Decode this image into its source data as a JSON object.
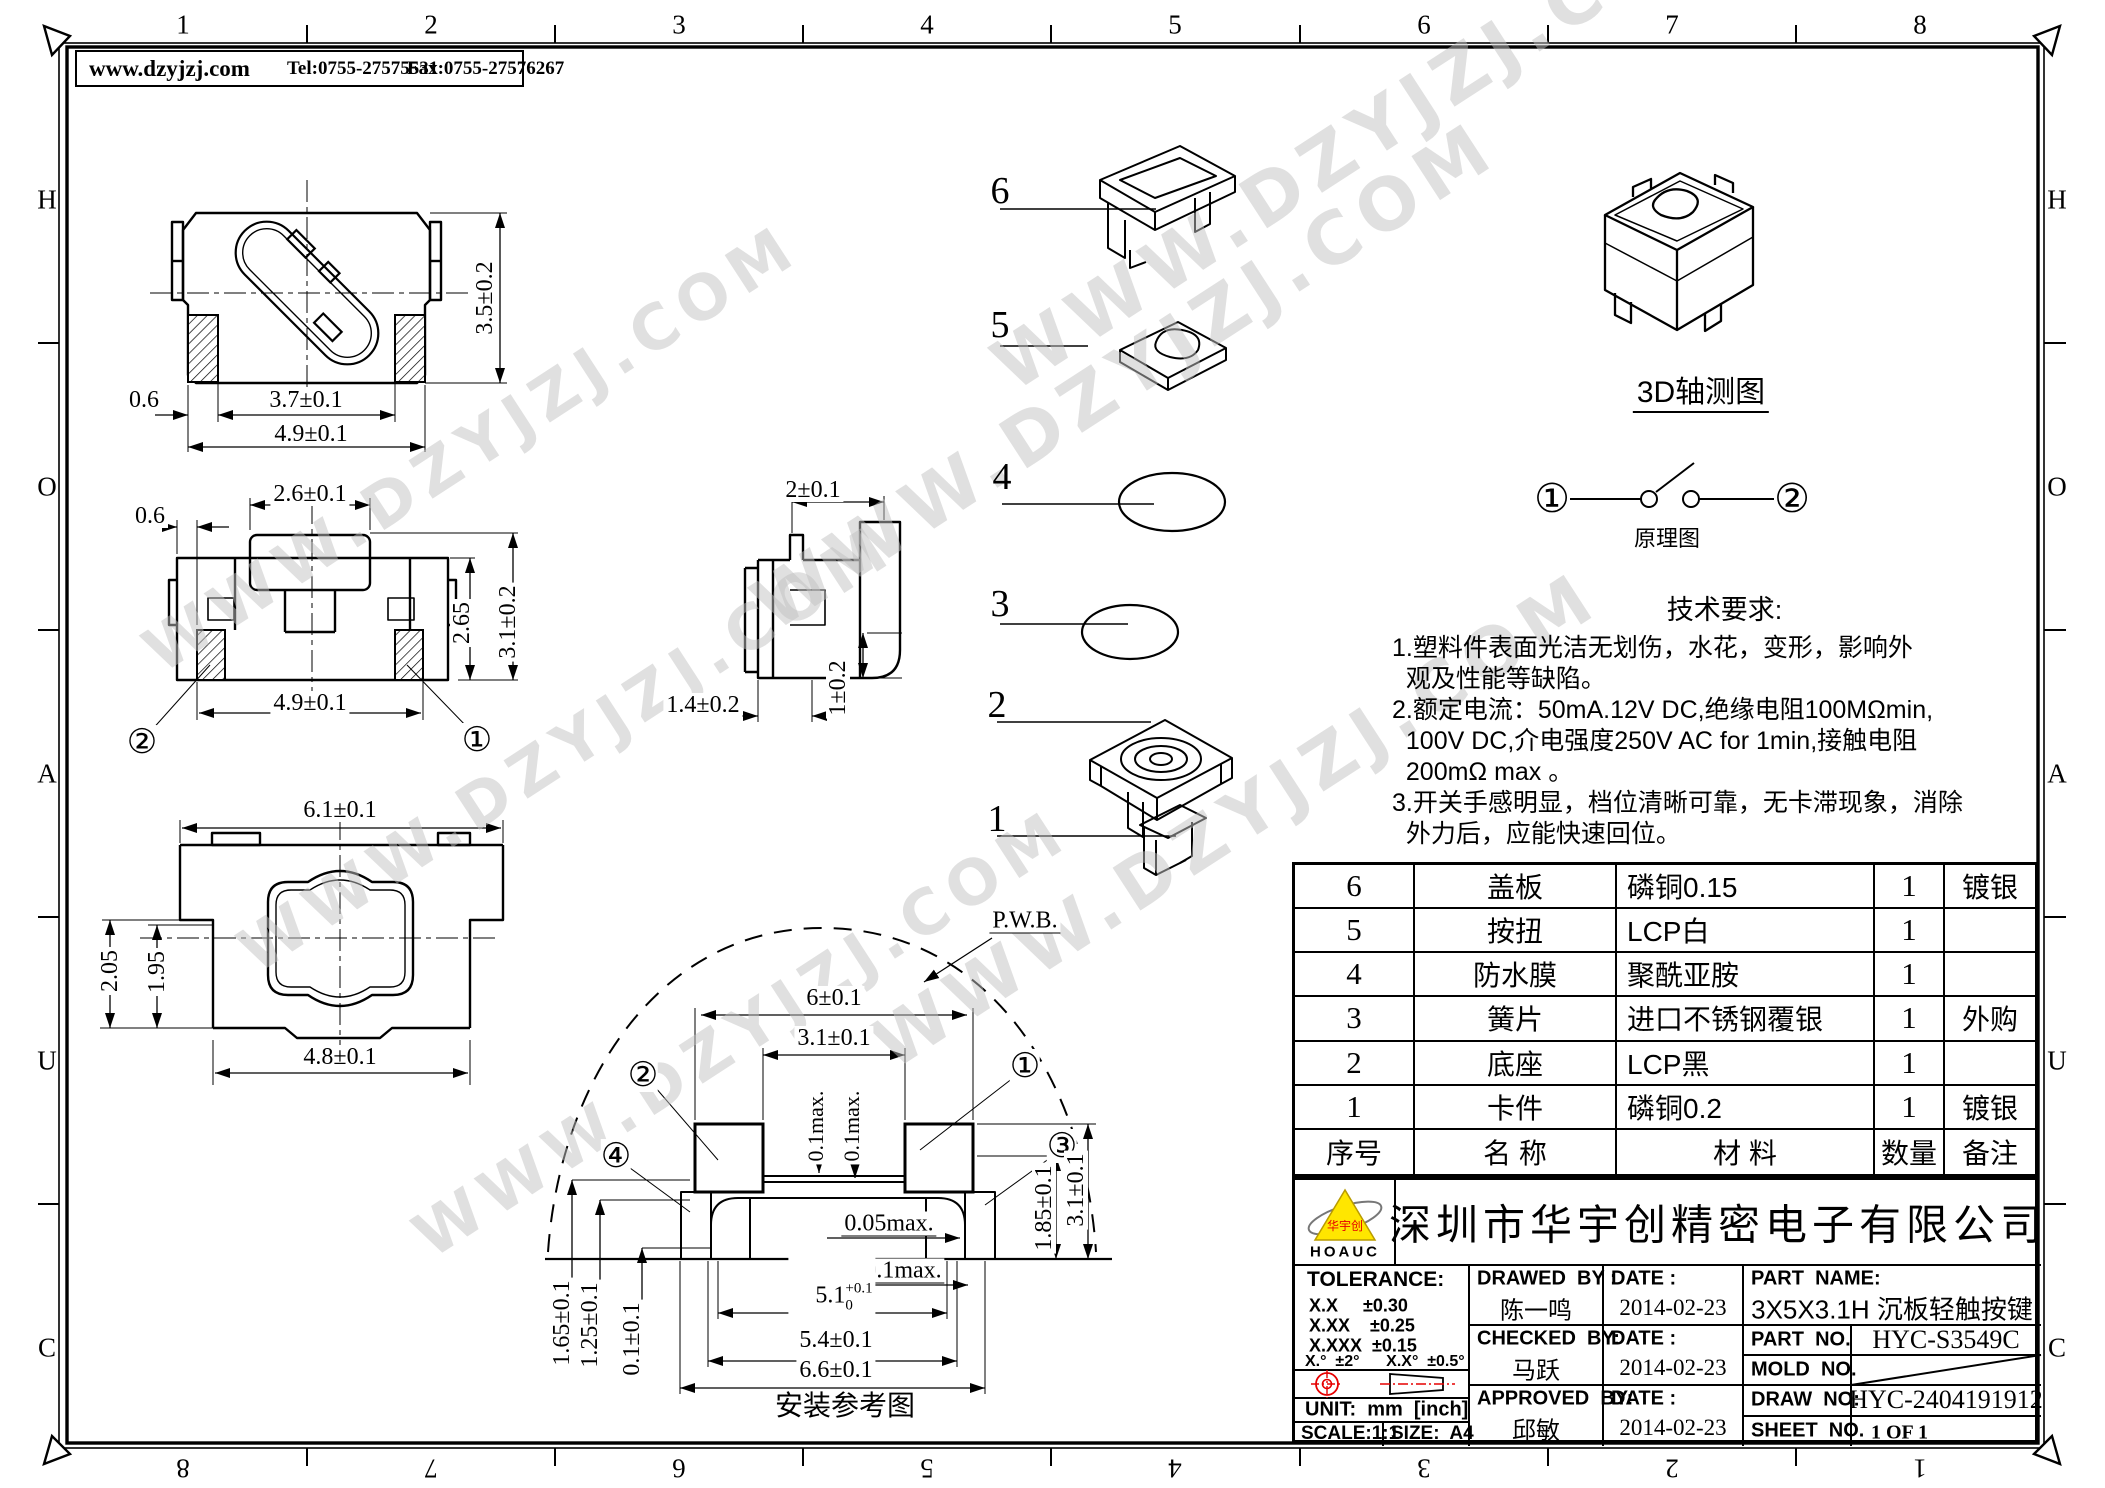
{
  "colors": {
    "line": "#000000",
    "red": "#e60000",
    "logo_yellow": "#ffe600",
    "watermark": "#c2c2c2"
  },
  "watermark_text": "WWW.DZYJZJ.COM",
  "page_header": {
    "website": "www.dzyjzj.com",
    "tel": "Tel:0755-27575531",
    "fax": "Fax:0755-27576267"
  },
  "border": {
    "top": [
      "1",
      "2",
      "3",
      "4",
      "5",
      "6",
      "7",
      "8"
    ],
    "bottom": [
      "8",
      "7",
      "6",
      "5",
      "4",
      "3",
      "2",
      "1"
    ],
    "left": [
      "H",
      "O",
      "A",
      "U",
      "C"
    ],
    "right": [
      "H",
      "O",
      "A",
      "U",
      "C"
    ]
  },
  "top_view": {
    "height": "3.5±0.2",
    "pad": "0.6",
    "inner": "3.7±0.1",
    "outer": "4.9±0.1"
  },
  "front_view": {
    "button": "2.6±0.1",
    "offset": "0.6",
    "body_h": "2.65",
    "total_h": "3.1±0.2",
    "width": "4.9±0.1",
    "ref_left": "②",
    "ref_right": "①"
  },
  "side_view": {
    "top": "2±0.1",
    "bottom": "1.4±0.2",
    "height": "1±0.2"
  },
  "bottom_view": {
    "width": "6.1±0.1",
    "h1": "2.05",
    "h2": "1.95",
    "bottom": "4.8±0.1"
  },
  "iso_view": {
    "label": "3D轴测图"
  },
  "schematic": {
    "label": "原理图",
    "n1": "①",
    "n2": "②"
  },
  "exploded": {
    "items": [
      "6",
      "5",
      "4",
      "3",
      "2",
      "1"
    ]
  },
  "install": {
    "pwb": "P.W.B.",
    "w1": "6±0.1",
    "w2": "3.1±0.1",
    "gap1": "0.1max.",
    "gap2": "0.1max.",
    "r1": "②",
    "r2": "①",
    "r3": "④",
    "r4": "③",
    "gap3": "0.05max.",
    "gap4": "0.1max.",
    "w3": "5.1",
    "w3_sup": "+0.1",
    "w3_sub": "0",
    "w4": "5.4±0.1",
    "w5": "6.6±0.1",
    "h1": "1.85±0.1",
    "h2": "3.1±0.1",
    "h3": "1.65±0.1",
    "h4": "1.25±0.1",
    "h5": "0.1±0.1",
    "caption": "安装参考图"
  },
  "tech": {
    "title": "技术要求:",
    "lines": [
      "1.塑料件表面光洁无划伤，水花，变形，影响外",
      "  观及性能等缺陷。",
      "2.额定电流：50mA.12V DC,绝缘电阻100MΩmin,",
      "  100V DC,介电强度250V AC for 1min,接触电阻",
      "  200mΩ max 。",
      "3.开关手感明显，档位清晰可靠，无卡滞现象，消除",
      "  外力后，应能快速回位。"
    ]
  },
  "bom": {
    "headers": {
      "no": "序号",
      "name": "名  称",
      "material": "材  料",
      "qty": "数量",
      "remark": "备注"
    },
    "rows": [
      {
        "no": "6",
        "name": "盖板",
        "material": "磷铜0.15",
        "qty": "1",
        "remark": "镀银"
      },
      {
        "no": "5",
        "name": "按扭",
        "material": "LCP白",
        "qty": "1",
        "remark": ""
      },
      {
        "no": "4",
        "name": "防水膜",
        "material": "聚酰亚胺",
        "qty": "1",
        "remark": ""
      },
      {
        "no": "3",
        "name": "簧片",
        "material": "进口不锈钢覆银",
        "qty": "1",
        "remark": "外购"
      },
      {
        "no": "2",
        "name": "底座",
        "material": "LCP黑",
        "qty": "1",
        "remark": ""
      },
      {
        "no": "1",
        "name": "卡件",
        "material": "磷铜0.2",
        "qty": "1",
        "remark": "镀银"
      }
    ]
  },
  "titleblock": {
    "logo_text": "HOAUC",
    "logo_cn": "华宇创",
    "company": "深圳市华宇创精密电子有限公司",
    "tolerance_title": "TOLERANCE:",
    "tol1": "X.X     ±0.30",
    "tol2": "X.XX    ±0.25",
    "tol3": "X.XXX  ±0.15",
    "tol4": "X.°  ±2°      X.X°  ±0.5°",
    "unit": "UNIT:  mm  [inch]",
    "scale": "SCALE:1:1",
    "size": "SIZE:  A4",
    "drawed_label": "DRAWED  BY :",
    "drawed_name": "陈一鸣",
    "checked_label": "CHECKED  BY:",
    "checked_name": "马跃",
    "approved_label": "APPROVED  BY:",
    "approved_name": "邱敏",
    "date_label": "DATE :",
    "date1": "2014-02-23",
    "date2": "2014-02-23",
    "date3": "2014-02-23",
    "part_name_label": "PART  NAME:",
    "part_name": "3X5X3.1H 沉板轻触按键",
    "part_no_label": "PART  NO.",
    "part_no": "HYC-S3549C",
    "mold_no_label": "MOLD  NO.",
    "draw_no_label": "DRAW  NO:",
    "draw_no": "HYC-2404191912",
    "sheet_no_label": "SHEET  NO.",
    "sheet_no": "1 OF 1"
  }
}
